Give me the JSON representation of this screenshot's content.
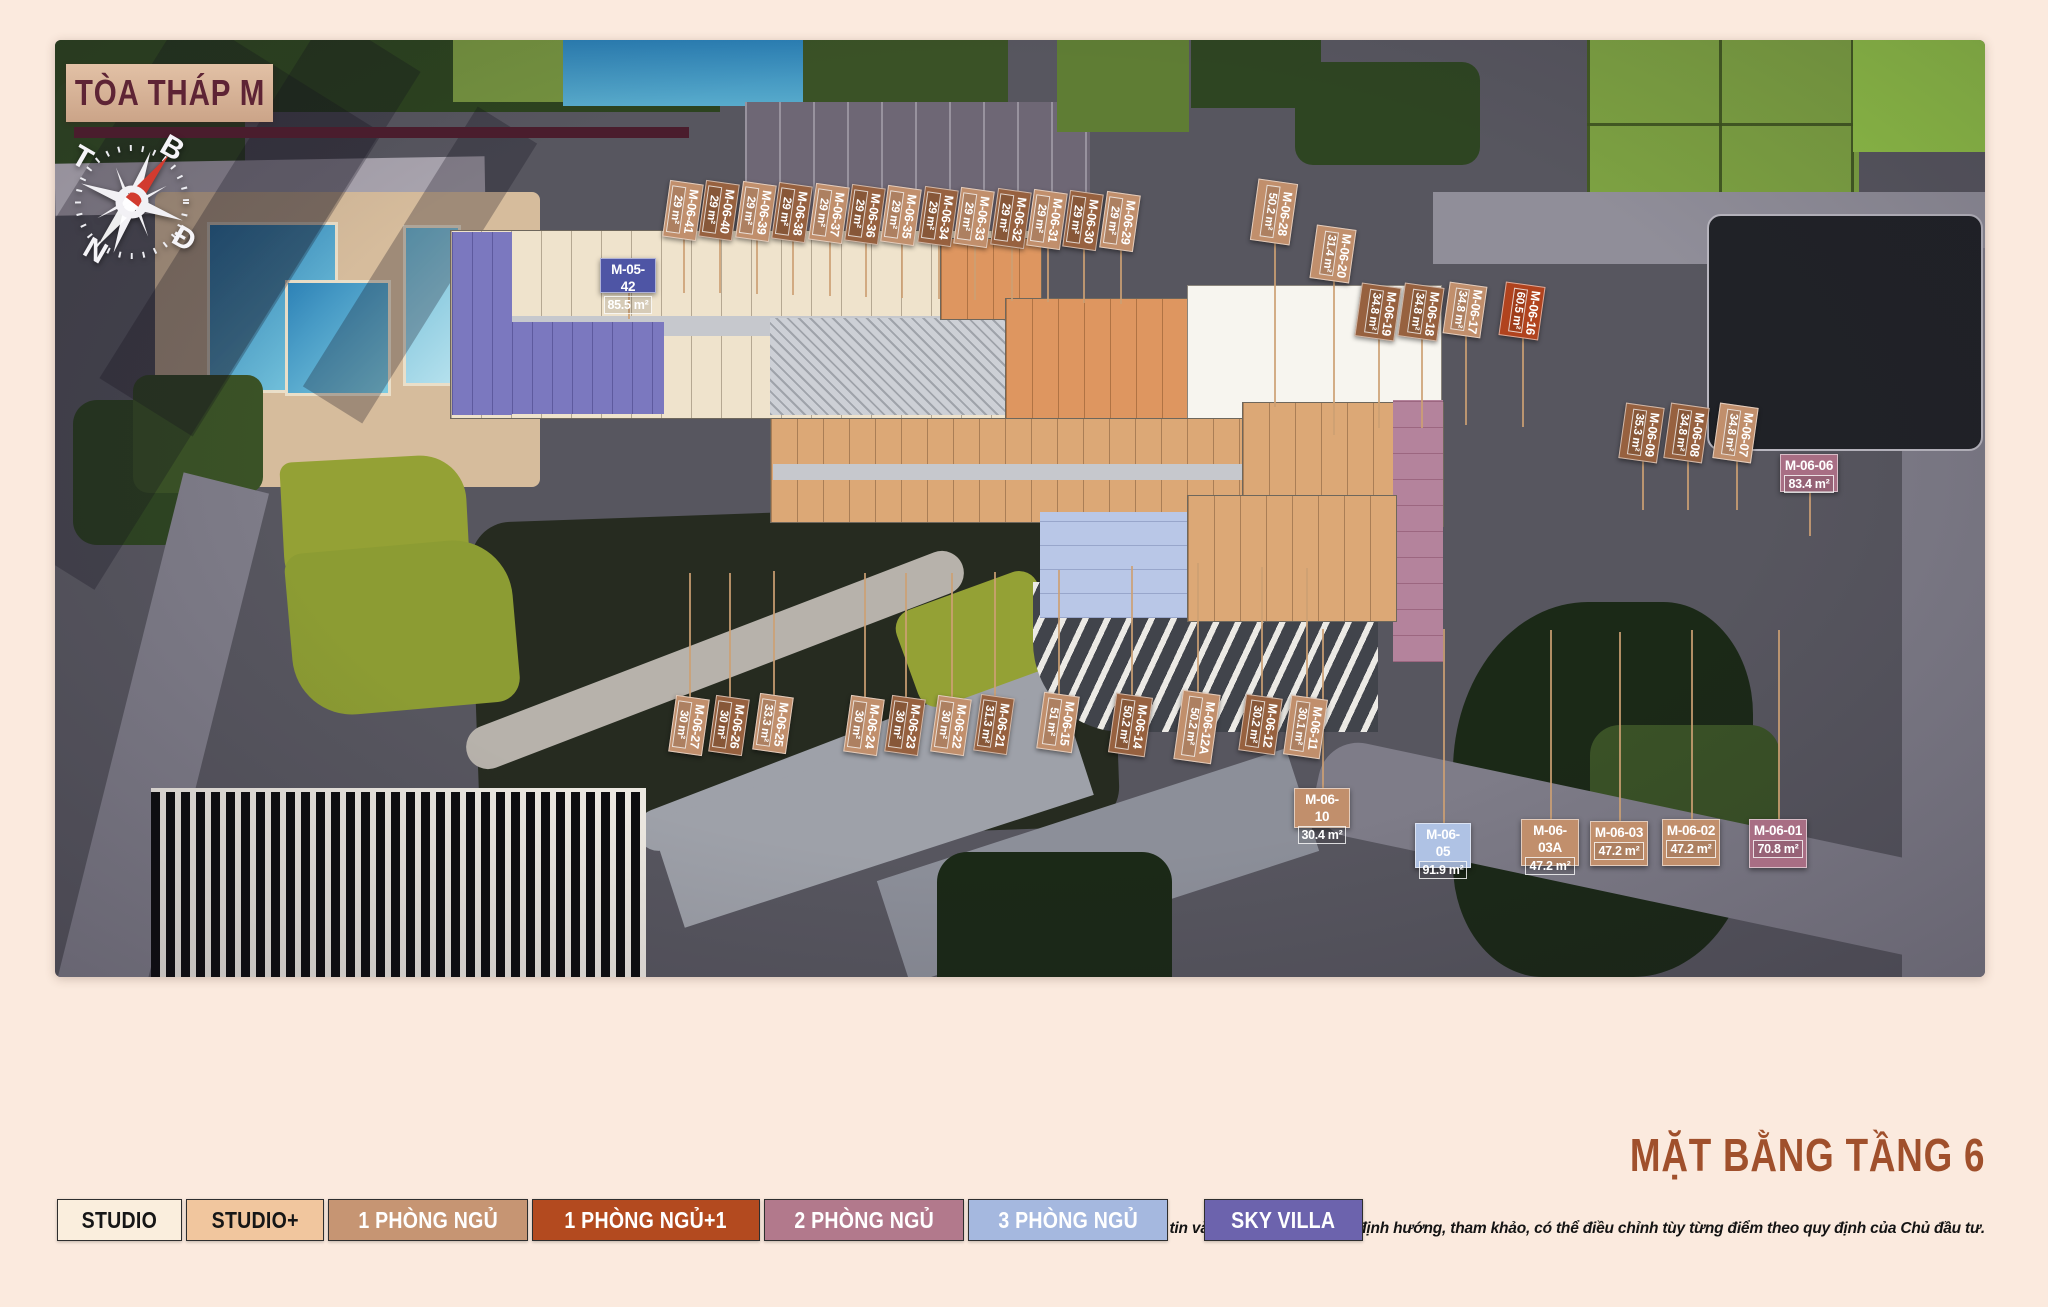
{
  "page": {
    "title_box": "TÒA THÁP M",
    "floor_title": "MẶT BẰNG TẦNG 6",
    "disclaimer": "*Hình ảnh, thông tin và thông số mang tính định hướng, tham khảo, có thể điều chỉnh tùy từng điểm theo quy định của Chủ đầu tư."
  },
  "compass": {
    "north": "B",
    "east": "Đ",
    "south": "N",
    "west": "T"
  },
  "legend": [
    {
      "label": "STUDIO",
      "color": "#FAEEDD",
      "text_color": "#161616"
    },
    {
      "label": "STUDIO+",
      "color": "#F1C69E",
      "text_color": "#161616"
    },
    {
      "label": "1 PHÒNG NGỦ",
      "color": "#C69573",
      "text_color": "#FFFFFF"
    },
    {
      "label": "1 PHÒNG NGỦ+1",
      "color": "#B34A1F",
      "text_color": "#FFFFFF"
    },
    {
      "label": "2 PHÒNG NGỦ",
      "color": "#B2798C",
      "text_color": "#FFFFFF"
    },
    {
      "label": "3 PHÒNG NGỦ",
      "color": "#A5B8DF",
      "text_color": "#FFFFFF"
    },
    {
      "label": "SKY VILLA",
      "color": "#6C63AD",
      "text_color": "#FFFFFF"
    }
  ],
  "units": [
    {
      "code": "M-06-41",
      "area": "29 m²",
      "tone": "light"
    },
    {
      "code": "M-06-40",
      "area": "29 m²",
      "tone": "dark"
    },
    {
      "code": "M-06-39",
      "area": "29 m²",
      "tone": "light"
    },
    {
      "code": "M-06-38",
      "area": "29 m²",
      "tone": "dark"
    },
    {
      "code": "M-06-37",
      "area": "29 m²",
      "tone": "light"
    },
    {
      "code": "M-06-36",
      "area": "29 m²",
      "tone": "dark"
    },
    {
      "code": "M-06-35",
      "area": "29 m²",
      "tone": "light"
    },
    {
      "code": "M-06-34",
      "area": "29 m²",
      "tone": "dark"
    },
    {
      "code": "M-06-33",
      "area": "29 m²",
      "tone": "light"
    },
    {
      "code": "M-06-32",
      "area": "29 m²",
      "tone": "dark"
    },
    {
      "code": "M-06-31",
      "area": "29 m²",
      "tone": "light"
    },
    {
      "code": "M-06-30",
      "area": "29 m²",
      "tone": "dark"
    },
    {
      "code": "M-06-29",
      "area": "29 m²",
      "tone": "light"
    },
    {
      "code": "M-06-28",
      "area": "50.2 m²",
      "tone": "light"
    },
    {
      "code": "M-06-20",
      "area": "31.4 m²",
      "tone": "light"
    },
    {
      "code": "M-06-19",
      "area": "34.8 m²",
      "tone": "dark"
    },
    {
      "code": "M-06-18",
      "area": "34.8 m²",
      "tone": "dark"
    },
    {
      "code": "M-06-17",
      "area": "34.8 m²",
      "tone": "light"
    },
    {
      "code": "M-06-16",
      "area": "60.5 m²",
      "tone": "red"
    },
    {
      "code": "M-06-09",
      "area": "35.3 m²",
      "tone": "dark"
    },
    {
      "code": "M-06-08",
      "area": "34.8 m²",
      "tone": "dark"
    },
    {
      "code": "M-06-07",
      "area": "34.8 m²",
      "tone": "light"
    },
    {
      "code": "M-06-06",
      "area": "83.4 m²",
      "tone": "mauve"
    },
    {
      "code": "M-05-42",
      "area": "85.5 m²",
      "tone": "purple"
    },
    {
      "code": "M-06-27",
      "area": "30 m²",
      "tone": "light"
    },
    {
      "code": "M-06-26",
      "area": "30 m²",
      "tone": "dark"
    },
    {
      "code": "M-06-25",
      "area": "33.3 m²",
      "tone": "light"
    },
    {
      "code": "M-06-24",
      "area": "30 m²",
      "tone": "light"
    },
    {
      "code": "M-06-23",
      "area": "30 m²",
      "tone": "dark"
    },
    {
      "code": "M-06-22",
      "area": "30 m²",
      "tone": "light"
    },
    {
      "code": "M-06-21",
      "area": "31.3 m²",
      "tone": "dark"
    },
    {
      "code": "M-06-15",
      "area": "51 m²",
      "tone": "light"
    },
    {
      "code": "M-06-14",
      "area": "50.2 m²",
      "tone": "dark"
    },
    {
      "code": "M-06-12A",
      "area": "50.2 m²",
      "tone": "light"
    },
    {
      "code": "M-06-12",
      "area": "30.2 m²",
      "tone": "dark"
    },
    {
      "code": "M-06-11",
      "area": "30.1 m²",
      "tone": "light"
    },
    {
      "code": "M-06-10",
      "area": "30.4 m²",
      "tone": "light"
    },
    {
      "code": "M-06-05",
      "area": "91.9 m²",
      "tone": "blue"
    },
    {
      "code": "M-06-03A",
      "area": "47.2 m²",
      "tone": "light"
    },
    {
      "code": "M-06-03",
      "area": "47.2 m²",
      "tone": "light"
    },
    {
      "code": "M-06-02",
      "area": "47.2 m²",
      "tone": "light"
    },
    {
      "code": "M-06-01",
      "area": "70.8 m²",
      "tone": "mauve"
    }
  ]
}
